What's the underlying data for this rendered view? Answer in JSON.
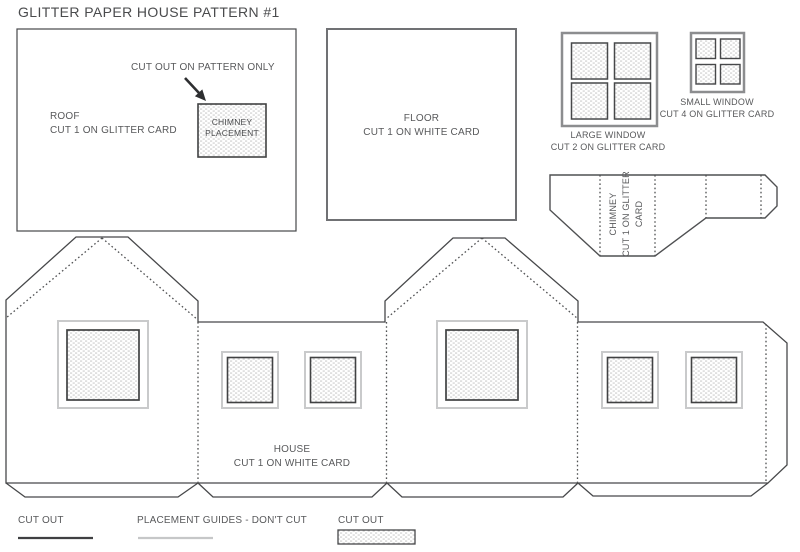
{
  "title": "GLITTER PAPER HOUSE PATTERN #1",
  "roof_piece": {
    "note": "CUT OUT ON PATTERN ONLY",
    "label_line1": "ROOF",
    "label_line2": "CUT 1 ON GLITTER CARD",
    "placement_line1": "CHIMNEY",
    "placement_line2": "PLACEMENT"
  },
  "floor_piece": {
    "label_line1": "FLOOR",
    "label_line2": "CUT 1 ON WHITE CARD"
  },
  "large_window_piece": {
    "label_line1": "LARGE WINDOW",
    "label_line2": "CUT 2 ON GLITTER CARD"
  },
  "small_window_piece": {
    "label_line1": "SMALL WINDOW",
    "label_line2": "CUT 4 ON GLITTER CARD"
  },
  "chimney_piece": {
    "label_line1": "CHIMNEY",
    "label_line2": "CUT 1 ON GLITTER",
    "label_line3": "CARD"
  },
  "house_piece": {
    "label_line1": "HOUSE",
    "label_line2": "CUT 1 ON WHITE CARD"
  },
  "legend": {
    "cut_line_label": "CUT OUT",
    "placement_label": "PLACEMENT GUIDES - DON'T CUT",
    "cut_swatch_label": "CUT OUT"
  },
  "colors": {
    "cut_line": "#47484a",
    "fold_line": "#4f5052",
    "text": "#58595b",
    "placement_guide": "#c9cacb",
    "window_frame_gray": "#8c8d8f",
    "glitter_dot": "#cccccc"
  }
}
